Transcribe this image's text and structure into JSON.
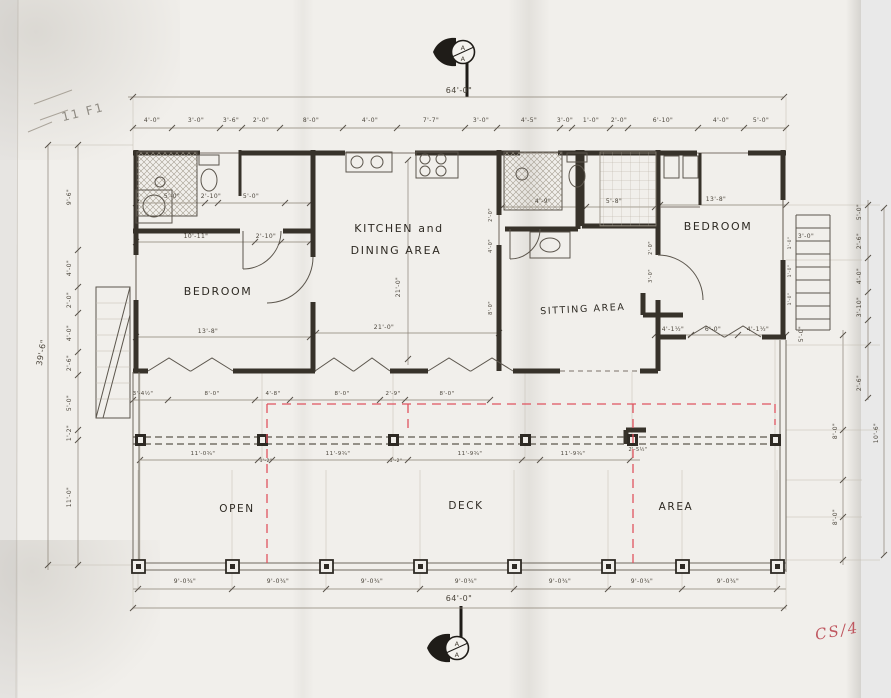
{
  "document": {
    "kind": "scanned hand-drawn architectural floor plan",
    "section_marker_letter": "A",
    "red_note": "CS/4",
    "pencil_note": "11 F1"
  },
  "colors": {
    "paper": "#f1efeb",
    "ink": "#38332b",
    "dim_ink": "#4a443a",
    "red_marking": "#e0535f",
    "red_note": "#bf565f",
    "pencil": "#8e8a82",
    "scan_strip": "#e9e9e9"
  },
  "rooms": [
    "BEDROOM",
    "KITCHEN and DINING AREA",
    "SITTING AREA",
    "BEDROOM",
    "OPEN",
    "DECK",
    "AREA"
  ],
  "overall_dimensions": {
    "width": "64'-0\"",
    "depth": "39'-6\""
  },
  "texts": [
    {
      "name": "room-label-bedroom-left",
      "text": "BEDROOM",
      "x": 218,
      "y": 295,
      "size": 11,
      "cls": "room"
    },
    {
      "name": "room-label-kitchen-1",
      "text": "KITCHEN and",
      "x": 399,
      "y": 232,
      "size": 11,
      "cls": "room"
    },
    {
      "name": "room-label-kitchen-2",
      "text": "DINING AREA",
      "x": 396,
      "y": 254,
      "size": 11,
      "cls": "room"
    },
    {
      "name": "room-label-sitting",
      "text": "SITTING AREA",
      "x": 583,
      "y": 312,
      "size": 9.5,
      "rot": -3,
      "cls": "room"
    },
    {
      "name": "room-label-bedroom-right",
      "text": "BEDROOM",
      "x": 718,
      "y": 230,
      "size": 11,
      "cls": "room"
    },
    {
      "name": "room-label-open",
      "text": "OPEN",
      "x": 237,
      "y": 512,
      "size": 10.5,
      "cls": "room"
    },
    {
      "name": "room-label-deck",
      "text": "DECK",
      "x": 466,
      "y": 509,
      "size": 10.5,
      "cls": "room"
    },
    {
      "name": "room-label-area",
      "text": "AREA",
      "x": 676,
      "y": 510,
      "size": 10.5,
      "cls": "room"
    },
    {
      "name": "dim-top-overall",
      "text": "64'-0\"",
      "x": 459,
      "y": 93,
      "size": 8,
      "cls": "dim"
    },
    {
      "name": "dim-bottom-overall",
      "text": "64'-0\"",
      "x": 459,
      "y": 601,
      "size": 8,
      "cls": "dim"
    },
    {
      "name": "dim-left-overall",
      "text": "39'-6\"",
      "x": 44,
      "y": 353,
      "size": 8,
      "rot": -80,
      "cls": "dim"
    },
    {
      "name": "note-pencil",
      "text": "11 F1",
      "x": 84,
      "y": 116,
      "size": 12,
      "rot": -14,
      "cls": "pencil"
    },
    {
      "name": "note-red-handwriting",
      "text": "CS/4",
      "x": 838,
      "y": 636,
      "size": 15,
      "rot": -10,
      "cls": "red"
    },
    {
      "name": "marker-top-letter-1",
      "text": "A",
      "x": 463,
      "y": 50,
      "size": 6.5,
      "cls": "dim"
    },
    {
      "name": "marker-top-letter-2",
      "text": "A",
      "x": 463,
      "y": 61,
      "size": 6.5,
      "cls": "dim"
    },
    {
      "name": "marker-bottom-letter-1",
      "text": "A",
      "x": 457,
      "y": 646,
      "size": 6.5,
      "cls": "dim"
    },
    {
      "name": "marker-bottom-letter-2",
      "text": "A",
      "x": 457,
      "y": 657,
      "size": 6.5,
      "cls": "dim"
    },
    {
      "name": "dim-top-1",
      "text": "4'-0\"",
      "x": 152,
      "y": 122,
      "size": 6,
      "cls": "dim"
    },
    {
      "name": "dim-top-2",
      "text": "3'-0\"",
      "x": 196,
      "y": 122,
      "size": 6,
      "cls": "dim"
    },
    {
      "name": "dim-top-3",
      "text": "3'-6\"",
      "x": 231,
      "y": 122,
      "size": 6,
      "cls": "dim"
    },
    {
      "name": "dim-top-4",
      "text": "2'-0\"",
      "x": 261,
      "y": 122,
      "size": 6,
      "cls": "dim"
    },
    {
      "name": "dim-top-5",
      "text": "8'-0\"",
      "x": 311,
      "y": 122,
      "size": 6,
      "cls": "dim"
    },
    {
      "name": "dim-top-6",
      "text": "4'-0\"",
      "x": 370,
      "y": 122,
      "size": 6,
      "cls": "dim"
    },
    {
      "name": "dim-top-7",
      "text": "7'-7\"",
      "x": 431,
      "y": 122,
      "size": 6,
      "cls": "dim"
    },
    {
      "name": "dim-top-8",
      "text": "3'-0\"",
      "x": 481,
      "y": 122,
      "size": 6,
      "cls": "dim"
    },
    {
      "name": "dim-top-9",
      "text": "4'-5\"",
      "x": 529,
      "y": 122,
      "size": 6,
      "cls": "dim"
    },
    {
      "name": "dim-top-10",
      "text": "3'-0\"",
      "x": 565,
      "y": 122,
      "size": 6,
      "cls": "dim"
    },
    {
      "name": "dim-top-11",
      "text": "1'-0\"",
      "x": 591,
      "y": 122,
      "size": 6,
      "cls": "dim"
    },
    {
      "name": "dim-top-12",
      "text": "2'-0\"",
      "x": 619,
      "y": 122,
      "size": 6,
      "cls": "dim"
    },
    {
      "name": "dim-top-13",
      "text": "6'-10\"",
      "x": 663,
      "y": 122,
      "size": 6,
      "cls": "dim"
    },
    {
      "name": "dim-top-14",
      "text": "4'-0\"",
      "x": 721,
      "y": 122,
      "size": 6,
      "cls": "dim"
    },
    {
      "name": "dim-top-15",
      "text": "5'-0\"",
      "x": 761,
      "y": 122,
      "size": 6,
      "cls": "dim"
    },
    {
      "name": "dim-bottom-1",
      "text": "9'-0¾\"",
      "x": 185,
      "y": 583,
      "size": 6,
      "cls": "dim"
    },
    {
      "name": "dim-bottom-2",
      "text": "9'-0¾\"",
      "x": 278,
      "y": 583,
      "size": 6,
      "cls": "dim"
    },
    {
      "name": "dim-bottom-3",
      "text": "9'-0¾\"",
      "x": 372,
      "y": 583,
      "size": 6,
      "cls": "dim"
    },
    {
      "name": "dim-bottom-4",
      "text": "9'-0¾\"",
      "x": 466,
      "y": 583,
      "size": 6,
      "cls": "dim"
    },
    {
      "name": "dim-bottom-5",
      "text": "9'-0¾\"",
      "x": 560,
      "y": 583,
      "size": 6,
      "cls": "dim"
    },
    {
      "name": "dim-bottom-6",
      "text": "9'-0¾\"",
      "x": 642,
      "y": 583,
      "size": 6,
      "cls": "dim"
    },
    {
      "name": "dim-bottom-7",
      "text": "9'-0¾\"",
      "x": 728,
      "y": 583,
      "size": 6,
      "cls": "dim"
    },
    {
      "name": "dim-left-1",
      "text": "9'-6\"",
      "x": 71,
      "y": 197,
      "size": 6,
      "rot": -90,
      "cls": "dim"
    },
    {
      "name": "dim-left-2",
      "text": "4'-0\"",
      "x": 71,
      "y": 268,
      "size": 6,
      "rot": -90,
      "cls": "dim"
    },
    {
      "name": "dim-left-3",
      "text": "2'-0\"",
      "x": 71,
      "y": 300,
      "size": 6,
      "rot": -90,
      "cls": "dim"
    },
    {
      "name": "dim-left-4",
      "text": "4'-0\"",
      "x": 71,
      "y": 333,
      "size": 6,
      "rot": -90,
      "cls": "dim"
    },
    {
      "name": "dim-left-5",
      "text": "2'-6\"",
      "x": 71,
      "y": 363,
      "size": 6,
      "rot": -90,
      "cls": "dim"
    },
    {
      "name": "dim-left-6",
      "text": "5'-0\"",
      "x": 71,
      "y": 403,
      "size": 6,
      "rot": -90,
      "cls": "dim"
    },
    {
      "name": "dim-left-7",
      "text": "1'-2\"",
      "x": 71,
      "y": 433,
      "size": 6,
      "rot": -90,
      "cls": "dim"
    },
    {
      "name": "dim-left-8",
      "text": "11'-0\"",
      "x": 71,
      "y": 497,
      "size": 6,
      "rot": -90,
      "cls": "dim"
    },
    {
      "name": "dim-right-1",
      "text": "5'-0\"",
      "x": 861,
      "y": 212,
      "size": 6,
      "rot": -90,
      "cls": "dim"
    },
    {
      "name": "dim-right-2",
      "text": "2'-6\"",
      "x": 861,
      "y": 241,
      "size": 6,
      "rot": -90,
      "cls": "dim"
    },
    {
      "name": "dim-right-3",
      "text": "4'-0\"",
      "x": 861,
      "y": 276,
      "size": 6,
      "rot": -90,
      "cls": "dim"
    },
    {
      "name": "dim-right-4",
      "text": "3'-10\"",
      "x": 861,
      "y": 307,
      "size": 6,
      "rot": -90,
      "cls": "dim"
    },
    {
      "name": "dim-right-5",
      "text": "2'-6\"",
      "x": 861,
      "y": 383,
      "size": 6,
      "rot": -90,
      "cls": "dim"
    },
    {
      "name": "dim-right-6",
      "text": "5'-0\"",
      "x": 803,
      "y": 334,
      "size": 6,
      "rot": -90,
      "cls": "dim"
    },
    {
      "name": "dim-right-7",
      "text": "3'-0\"",
      "x": 806,
      "y": 238,
      "size": 6,
      "cls": "dim"
    },
    {
      "name": "dim-right-8",
      "text": "8'-0\"",
      "x": 837,
      "y": 431,
      "size": 6,
      "rot": -90,
      "cls": "dim"
    },
    {
      "name": "dim-right-9",
      "text": "8'-0\"",
      "x": 837,
      "y": 517,
      "size": 6,
      "rot": -90,
      "cls": "dim"
    },
    {
      "name": "dim-right-10",
      "text": "10'-6\"",
      "x": 878,
      "y": 433,
      "size": 6,
      "rot": -90,
      "cls": "dim"
    },
    {
      "name": "dim-stair-1",
      "text": "1'-0\"",
      "x": 791,
      "y": 243,
      "size": 4.5,
      "rot": -90,
      "cls": "dim"
    },
    {
      "name": "dim-stair-2",
      "text": "1'-0\"",
      "x": 791,
      "y": 271,
      "size": 4.5,
      "rot": -90,
      "cls": "dim"
    },
    {
      "name": "dim-stair-3",
      "text": "1'-0\"",
      "x": 791,
      "y": 299,
      "size": 4.5,
      "rot": -90,
      "cls": "dim"
    },
    {
      "name": "dim-bath1-1",
      "text": "5'-0\"",
      "x": 172,
      "y": 198,
      "size": 6,
      "cls": "dim"
    },
    {
      "name": "dim-bath1-2",
      "text": "2'-10\"",
      "x": 211,
      "y": 198,
      "size": 6,
      "cls": "dim"
    },
    {
      "name": "dim-bath1-3",
      "text": "5'-0\"",
      "x": 251,
      "y": 198,
      "size": 6,
      "cls": "dim"
    },
    {
      "name": "dim-bath1-4",
      "text": "10'-11\"",
      "x": 196,
      "y": 238,
      "size": 6,
      "cls": "dim"
    },
    {
      "name": "dim-bath1-5",
      "text": "2'-10\"",
      "x": 266,
      "y": 238,
      "size": 6,
      "cls": "dim"
    },
    {
      "name": "dim-bedroom-left",
      "text": "13'-8\"",
      "x": 208,
      "y": 333,
      "size": 6,
      "cls": "dim"
    },
    {
      "name": "dim-kitchen-w",
      "text": "21'-0\"",
      "x": 384,
      "y": 329,
      "size": 6,
      "cls": "dim"
    },
    {
      "name": "dim-kitchen-h",
      "text": "21'-0\"",
      "x": 400,
      "y": 287,
      "size": 6,
      "rot": -90,
      "cls": "dim"
    },
    {
      "name": "dim-bath2-1",
      "text": "4'-9\"",
      "x": 543,
      "y": 203,
      "size": 6,
      "cls": "dim"
    },
    {
      "name": "dim-bath2-2",
      "text": "5'-8\"",
      "x": 614,
      "y": 203,
      "size": 6,
      "cls": "dim"
    },
    {
      "name": "dim-hall-1",
      "text": "2'-0\"",
      "x": 492,
      "y": 215,
      "size": 5,
      "rot": -90,
      "cls": "dim"
    },
    {
      "name": "dim-hall-2",
      "text": "4'-0\"",
      "x": 492,
      "y": 246,
      "size": 5,
      "rot": -90,
      "cls": "dim"
    },
    {
      "name": "dim-hall-3",
      "text": "8'-0\"",
      "x": 492,
      "y": 308,
      "size": 5,
      "rot": -90,
      "cls": "dim"
    },
    {
      "name": "dim-bedroom-right",
      "text": "13'-8\"",
      "x": 716,
      "y": 201,
      "size": 6,
      "cls": "dim"
    },
    {
      "name": "dim-br2-side-1",
      "text": "2'-0\"",
      "x": 652,
      "y": 248,
      "size": 5,
      "rot": -90,
      "cls": "dim"
    },
    {
      "name": "dim-br2-side-2",
      "text": "3'-0\"",
      "x": 652,
      "y": 276,
      "size": 5,
      "rot": -90,
      "cls": "dim"
    },
    {
      "name": "dim-sit-1",
      "text": "4'-1½\"",
      "x": 673,
      "y": 331,
      "size": 6,
      "cls": "dim"
    },
    {
      "name": "dim-sit-2",
      "text": "6'-0\"",
      "x": 713,
      "y": 331,
      "size": 6,
      "cls": "dim"
    },
    {
      "name": "dim-sit-3",
      "text": "4'-1½\"",
      "x": 758,
      "y": 331,
      "size": 6,
      "cls": "dim"
    },
    {
      "name": "dim-mid-1",
      "text": "3'-4½\"",
      "x": 143,
      "y": 395,
      "size": 5.5,
      "cls": "dim"
    },
    {
      "name": "dim-mid-2",
      "text": "8'-0\"",
      "x": 212,
      "y": 395,
      "size": 5.5,
      "cls": "dim"
    },
    {
      "name": "dim-mid-3",
      "text": "4'-8\"",
      "x": 273,
      "y": 395,
      "size": 5.5,
      "cls": "dim"
    },
    {
      "name": "dim-mid-4",
      "text": "8'-0\"",
      "x": 342,
      "y": 395,
      "size": 5.5,
      "cls": "dim"
    },
    {
      "name": "dim-mid-5",
      "text": "2'-9\"",
      "x": 393,
      "y": 395,
      "size": 5.5,
      "cls": "dim"
    },
    {
      "name": "dim-mid-6",
      "text": "8'-0\"",
      "x": 447,
      "y": 395,
      "size": 5.5,
      "cls": "dim"
    },
    {
      "name": "dim-beam-1",
      "text": "11'-0¾\"",
      "x": 203,
      "y": 455,
      "size": 5.5,
      "cls": "dim"
    },
    {
      "name": "dim-beam-2",
      "text": "11'-9¾\"",
      "x": 338,
      "y": 455,
      "size": 5.5,
      "cls": "dim"
    },
    {
      "name": "dim-beam-3",
      "text": "11'-9¾\"",
      "x": 470,
      "y": 455,
      "size": 5.5,
      "cls": "dim"
    },
    {
      "name": "dim-beam-4",
      "text": "11'-9¾\"",
      "x": 573,
      "y": 455,
      "size": 5.5,
      "cls": "dim"
    },
    {
      "name": "dim-beam-5",
      "text": "2'-5½\"",
      "x": 638,
      "y": 451,
      "size": 5,
      "cls": "dim"
    },
    {
      "name": "dim-beam-6",
      "text": "1'-2\"",
      "x": 266,
      "y": 462,
      "size": 4.5,
      "cls": "dim"
    },
    {
      "name": "dim-beam-7",
      "text": "1'-2\"",
      "x": 396,
      "y": 462,
      "size": 4.5,
      "cls": "dim"
    }
  ]
}
